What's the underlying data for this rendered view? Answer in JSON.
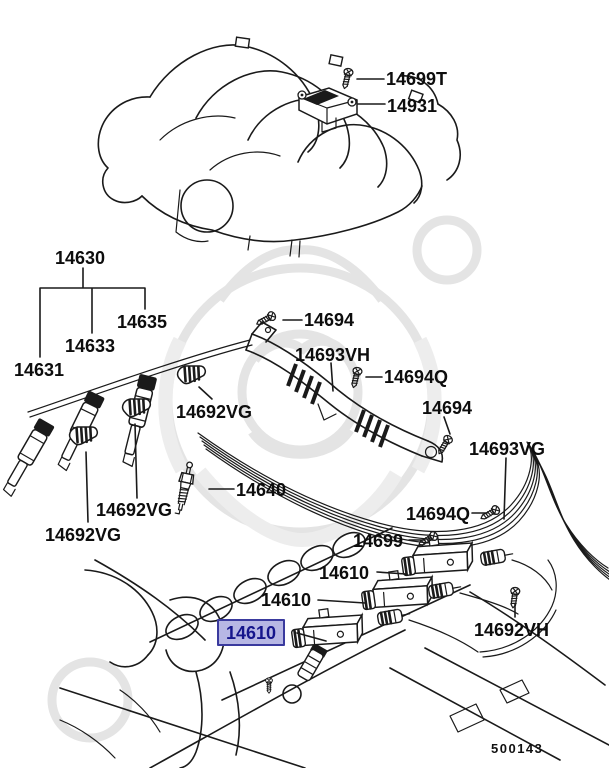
{
  "diagram": {
    "drawing_number": "500143",
    "selected_part": "14610",
    "highlight": {
      "bg": "#b7b7e4",
      "border": "#3a3a9e",
      "text_color": "#15158c"
    },
    "labels": [
      {
        "id": "14699T",
        "text": "14699T"
      },
      {
        "id": "14931",
        "text": "14931"
      },
      {
        "id": "14630",
        "text": "14630"
      },
      {
        "id": "14635",
        "text": "14635"
      },
      {
        "id": "14633",
        "text": "14633"
      },
      {
        "id": "14631",
        "text": "14631"
      },
      {
        "id": "14694-top",
        "text": "14694"
      },
      {
        "id": "14693VH",
        "text": "14693VH"
      },
      {
        "id": "14694Q-1",
        "text": "14694Q"
      },
      {
        "id": "14692VG-1",
        "text": "14692VG"
      },
      {
        "id": "14694-rt",
        "text": "14694"
      },
      {
        "id": "14693VG",
        "text": "14693VG"
      },
      {
        "id": "14640",
        "text": "14640"
      },
      {
        "id": "14692VG-2",
        "text": "14692VG"
      },
      {
        "id": "14694Q-2",
        "text": "14694Q"
      },
      {
        "id": "14692VG-3",
        "text": "14692VG"
      },
      {
        "id": "14699",
        "text": "14699"
      },
      {
        "id": "14610-1",
        "text": "14610"
      },
      {
        "id": "14610-2",
        "text": "14610"
      },
      {
        "id": "14610-3",
        "text": "14610",
        "selected": true
      },
      {
        "id": "14692VH",
        "text": "14692VH"
      }
    ]
  }
}
